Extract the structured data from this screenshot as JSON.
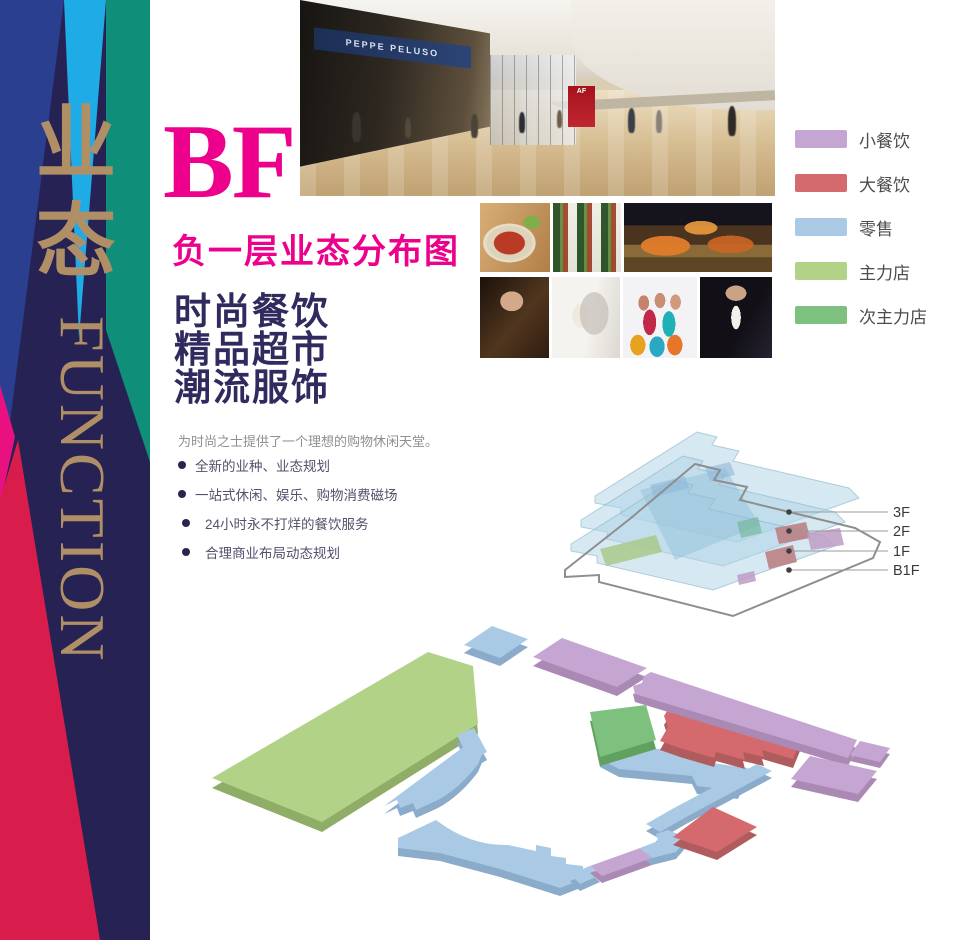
{
  "banner": {
    "vertical_cn": "业态",
    "vertical_en": "FUNCTION",
    "colors": {
      "navy": "#262253",
      "royal": "#2b3f90",
      "cyan": "#1fabe5",
      "teal": "#0f8e7a",
      "magenta": "#e8117f",
      "crimson": "#d81d4d",
      "gold": "#b18f66"
    }
  },
  "header": {
    "floor_code": "BF",
    "title": "负一层业态分布图",
    "accent": "#ec008c"
  },
  "headline_lines": [
    "时尚餐饮",
    "精品超市",
    "潮流服饰"
  ],
  "intro": "为时尚之士提供了一个理想的购物休闲天堂。",
  "bullets": [
    "全新的业种、业态规划",
    "一站式休闲、娱乐、购物消费磁场",
    "24小时永不打烊的餐饮服务",
    "合理商业布局动态规划"
  ],
  "legend": {
    "items": [
      {
        "label": "小餐饮",
        "color": "#c5a6d2"
      },
      {
        "label": "大餐饮",
        "color": "#d56a6e"
      },
      {
        "label": "零售",
        "color": "#aac9e4"
      },
      {
        "label": "主力店",
        "color": "#b2d287"
      },
      {
        "label": "次主力店",
        "color": "#7ec17e"
      }
    ]
  },
  "floor_stack": {
    "labels": [
      "3F",
      "2F",
      "1F",
      "B1F"
    ]
  },
  "photos": {
    "mall_sign": "PEPPE PELUSO",
    "accent_sign": "AF"
  }
}
